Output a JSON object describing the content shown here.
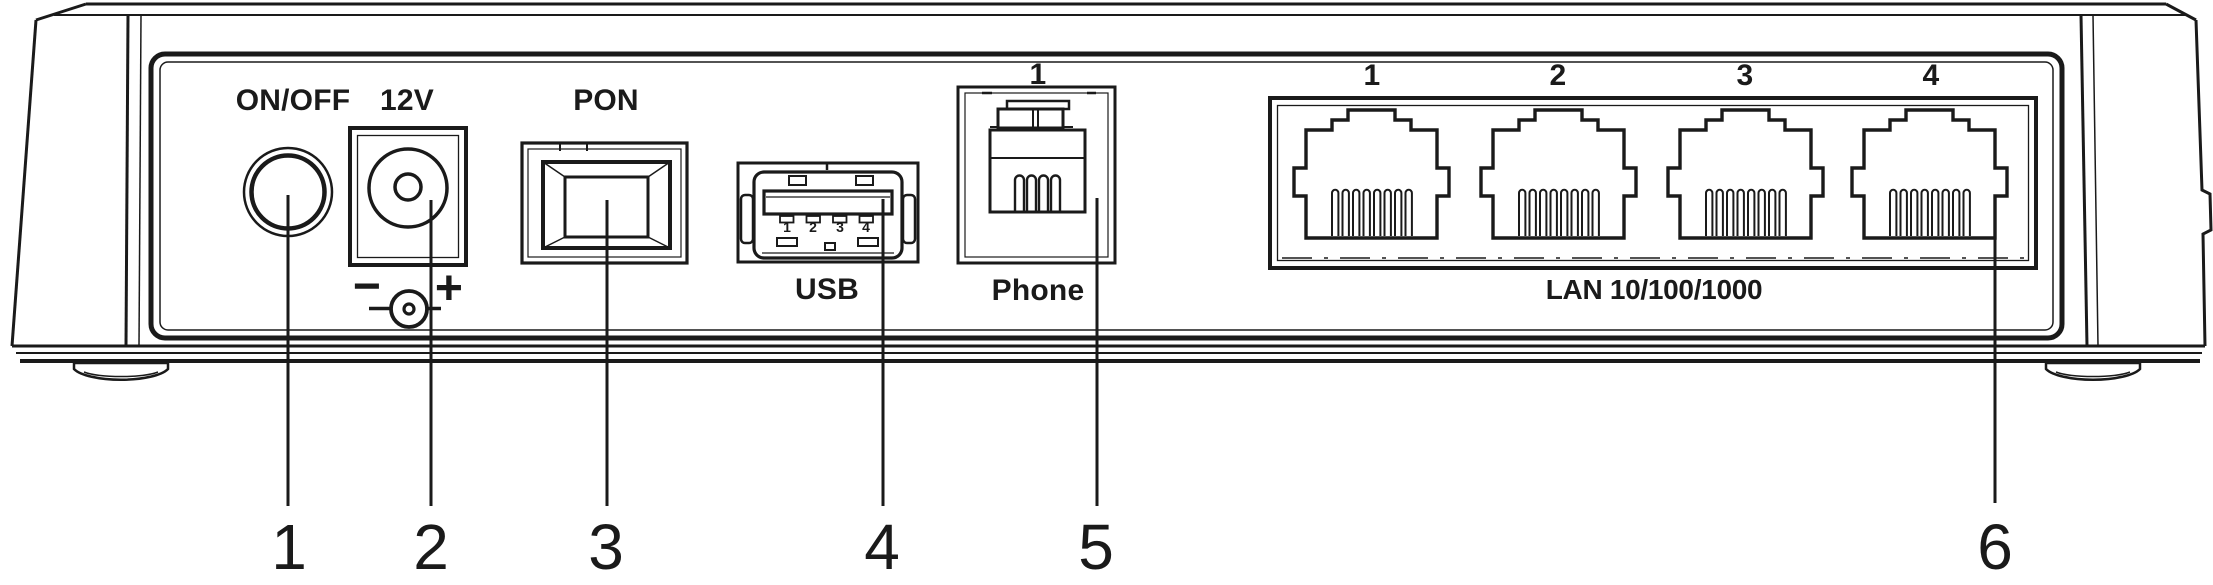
{
  "device": {
    "description": "Rear panel connection diagram of network terminal",
    "panel": {
      "power_button": {
        "label": "ON/OFF",
        "callout": "1"
      },
      "power_jack": {
        "label": "12V",
        "polarity_minus": "−",
        "polarity_plus": "+",
        "callout": "2"
      },
      "pon_port": {
        "label": "PON",
        "callout": "3"
      },
      "usb_port": {
        "label": "USB",
        "pin_numbers": [
          "1",
          "2",
          "3",
          "4"
        ],
        "callout": "4"
      },
      "phone_port": {
        "label": "Phone",
        "port_number": "1",
        "callout": "5"
      },
      "lan_ports": {
        "label": "LAN 10/100/1000",
        "port_numbers": [
          "1",
          "2",
          "3",
          "4"
        ],
        "callout": "6"
      }
    }
  },
  "callouts": [
    {
      "number": "1",
      "target": "power-button"
    },
    {
      "number": "2",
      "target": "power-jack-12v"
    },
    {
      "number": "3",
      "target": "pon-port"
    },
    {
      "number": "4",
      "target": "usb-port"
    },
    {
      "number": "5",
      "target": "phone-port"
    },
    {
      "number": "6",
      "target": "lan-ports"
    }
  ],
  "colors": {
    "line": "#1a1a1a",
    "background": "#ffffff"
  }
}
